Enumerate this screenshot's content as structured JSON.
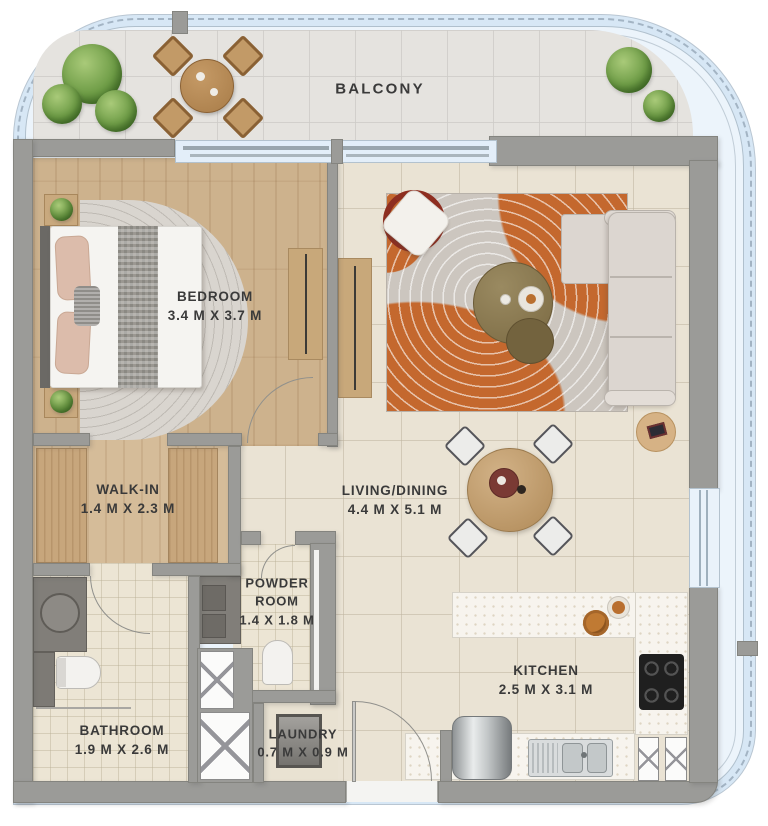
{
  "labels": {
    "balcony": {
      "name": "BALCONY",
      "dims": ""
    },
    "bedroom": {
      "name": "BEDROOM",
      "dims": "3.4 M X 3.7 M"
    },
    "living_dining": {
      "name": "LIVING/DINING",
      "dims": "4.4 M X 5.1 M"
    },
    "walk_in": {
      "name": "WALK-IN",
      "dims": "1.4 M X 2.3 M"
    },
    "powder_room": {
      "name": "POWDER ROOM",
      "dims": "1.4 X 1.8 M"
    },
    "bathroom": {
      "name": "BATHROOM",
      "dims": "1.9 M X 2.6 M"
    },
    "laundry": {
      "name": "LAUNDRY",
      "dims": "0.7 M X 0.9 M"
    },
    "kitchen": {
      "name": "KITCHEN",
      "dims": "2.5 M X 3.1 M"
    }
  },
  "colors": {
    "wall_gray": "#9b9b98",
    "glass_blue": "#d7e7f5",
    "balcony_floor": "#e5e3df",
    "wood_floor": "#cdb28d",
    "tile_floor": "#eae3d4",
    "rug_orange": "#c4682e",
    "counter_white": "#f7f4ee",
    "plant_green": "#6f9d47"
  }
}
